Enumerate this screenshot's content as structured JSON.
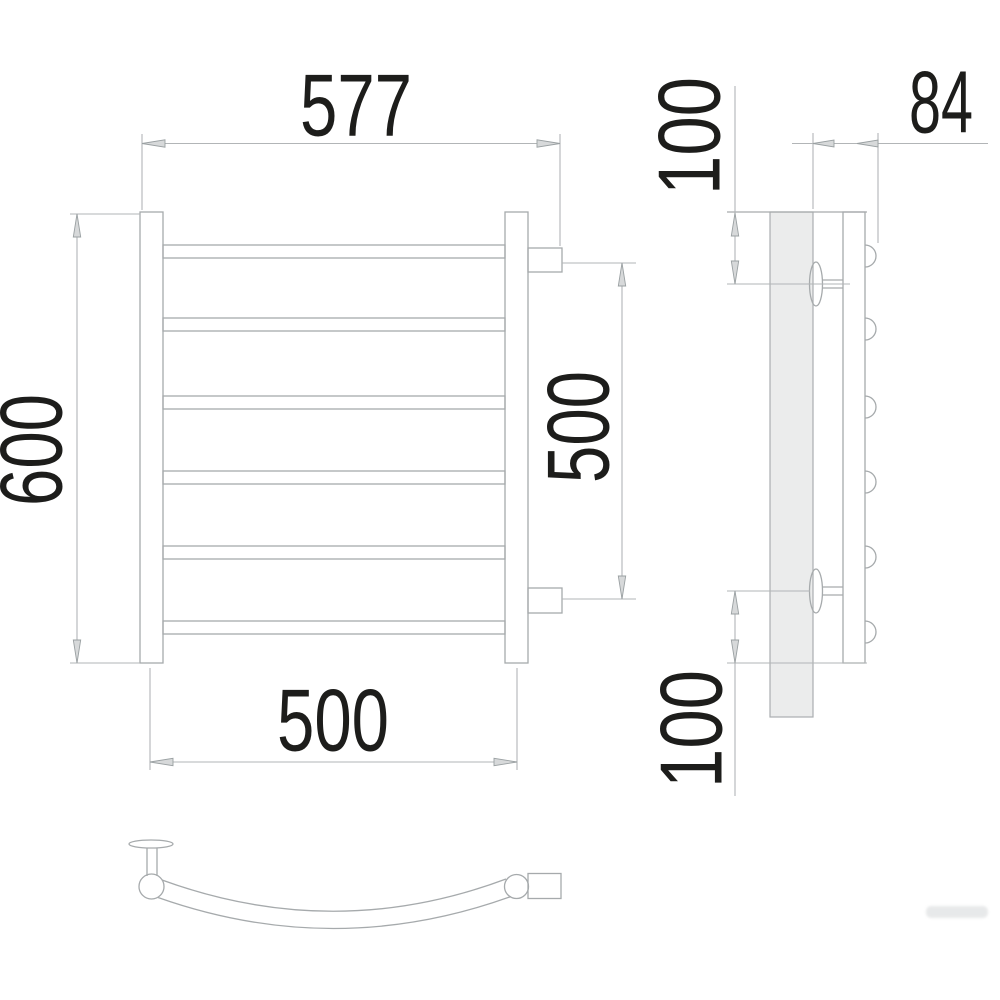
{
  "drawing": {
    "title": "towel-rail-dimension-drawing",
    "views": {
      "front": "front-view",
      "side": "side-view",
      "bottom": "bottom-plan-view"
    },
    "rung_count": 6,
    "colors": {
      "background": "#ffffff",
      "outline": "#a6aaac",
      "dimension_lines": "#b2b5b7",
      "label_text": "#1d1d1b",
      "wall_plate_fill": "#ebecec"
    }
  },
  "dimensions": {
    "total_width": "577",
    "total_height": "600",
    "bracket_span": "500",
    "bottom_width": "500",
    "top_offset": "100",
    "depth": "84",
    "bottom_offset": "100"
  }
}
